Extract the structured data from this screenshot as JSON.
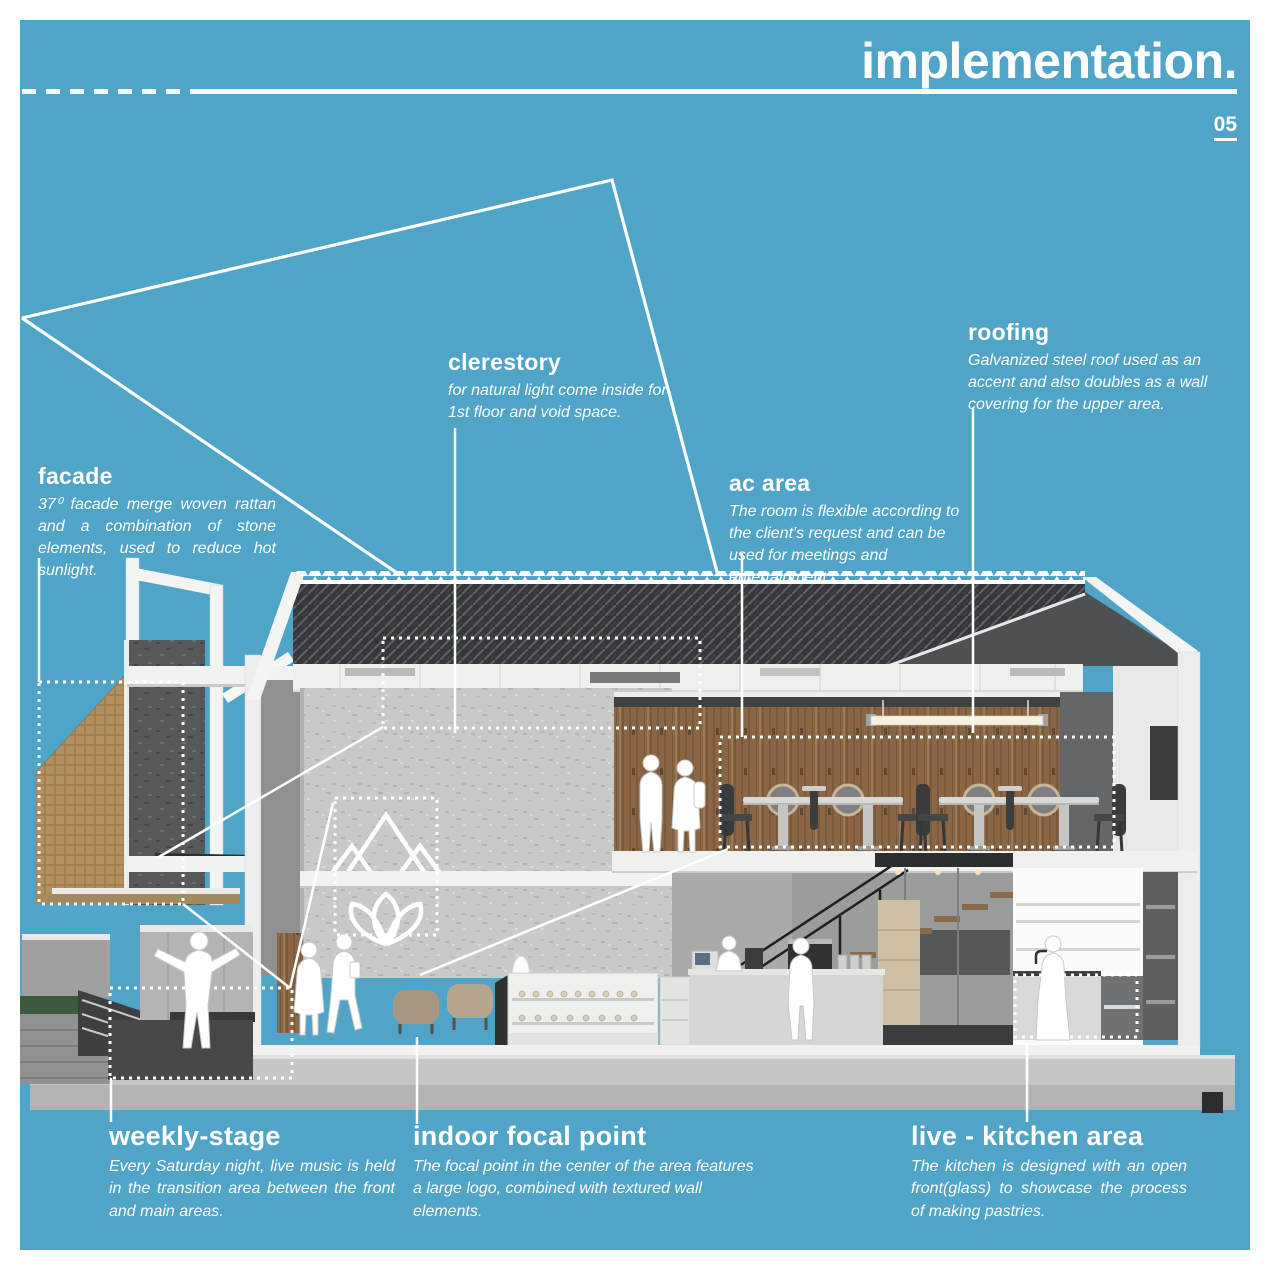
{
  "page": {
    "title": "implementation.",
    "page_number": "05"
  },
  "colors": {
    "background": "#4FA4C8",
    "text": "#FFFFFF",
    "roof_dark": "#35383A",
    "wood_wall": "#8A6644",
    "rattan_panel": "#B3915F",
    "stone_wall": "#C9CAC8"
  },
  "icons": {
    "figures": [
      "performer-figure",
      "walking-woman-figure",
      "walking-man-figure",
      "man-with-cap-figure",
      "woman-with-backpack-figure",
      "cashier-figure",
      "barista-figure",
      "chef-figure"
    ]
  },
  "annotations": {
    "facade": {
      "heading": "facade",
      "body": "37⁰ facade merge woven rattan and a combination of stone elements,  used to reduce hot sunlight."
    },
    "clerestory": {
      "heading": "clerestory",
      "body": "for natural light come inside for 1st floor and void space."
    },
    "roofing": {
      "heading": "roofing",
      "body": "Galvanized steel roof used as an accent and also doubles as a wall covering for the upper area."
    },
    "ac_area": {
      "heading": "ac area",
      "body": "The room is flexible according to the client's request and can be used for meetings and entertainment."
    },
    "weekly_stage": {
      "heading": "weekly-stage",
      "body": "Every Saturday night, live music is held in the transition area between the front and main areas."
    },
    "indoor_focal_point": {
      "heading": "indoor focal point",
      "body": "The focal point in the center of the area features a large logo, combined with textured wall elements."
    },
    "live_kitchen": {
      "heading": "live - kitchen area",
      "body": "The kitchen is designed with an open front(glass) to showcase the process of making pastries."
    }
  }
}
